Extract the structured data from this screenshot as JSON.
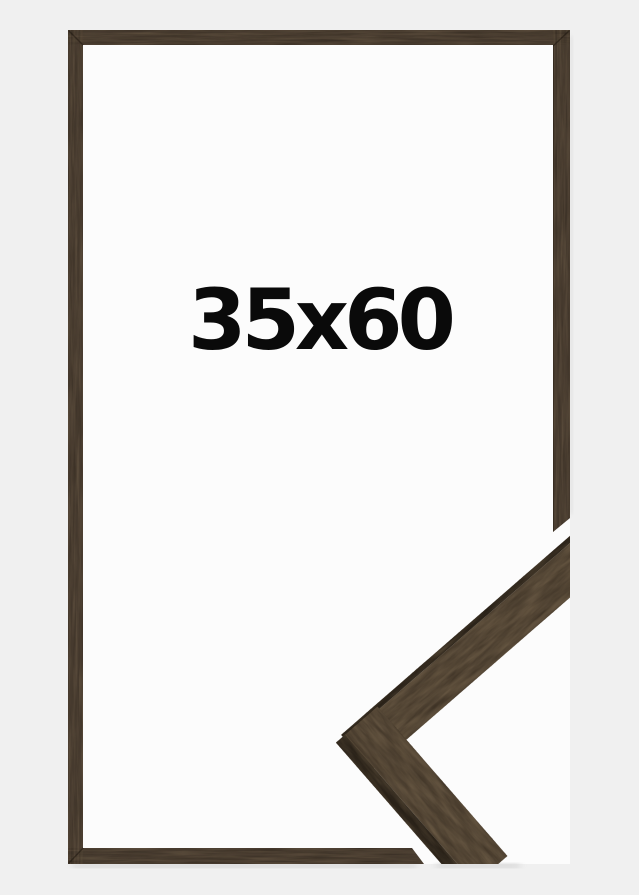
{
  "image": {
    "size_label": "35x60"
  },
  "colors": {
    "background": "#f0f0f0",
    "inner_background": "#fcfcfc",
    "wood_base": "#4d4033",
    "wood_face": "#584a39",
    "wood_edge_dark": "#2f271d",
    "label_text": "#0a0a0a"
  }
}
